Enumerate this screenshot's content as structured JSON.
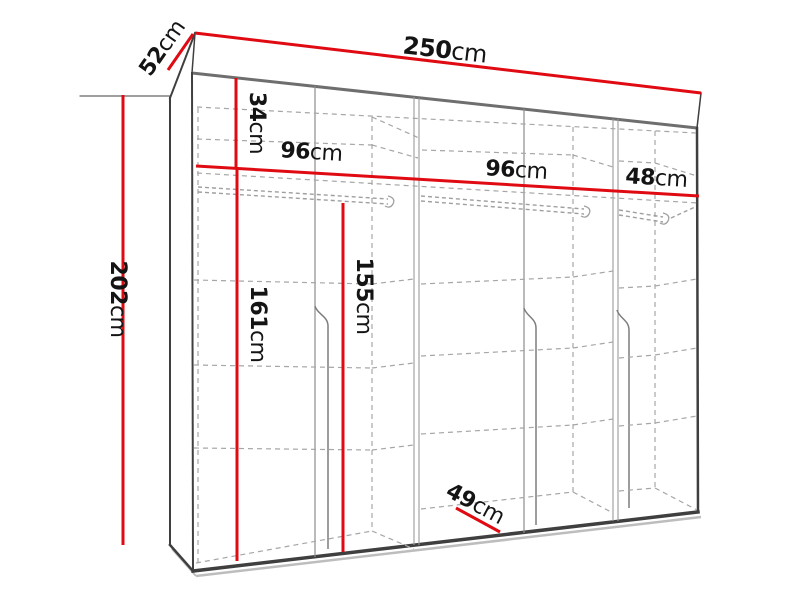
{
  "title": "wardrobe-dimensions-diagram",
  "colors": {
    "accent": "#e00b12",
    "edge-dark": "#3f3f3f",
    "edge-gray": "#6e6e6e",
    "line-gray": "#8c8c8c",
    "dash-gray": "#a6a6a6",
    "text": "#141414",
    "shadow": "#bdbdbd",
    "bg": "#ffffff"
  },
  "dimensions": {
    "width": {
      "value": "250",
      "unit": "cm"
    },
    "depth": {
      "value": "52",
      "unit": "cm"
    },
    "height": {
      "value": "202",
      "unit": "cm"
    },
    "top_shelf": {
      "value": "34",
      "unit": "cm"
    },
    "section_left": {
      "value": "96",
      "unit": "cm"
    },
    "section_middle": {
      "value": "96",
      "unit": "cm"
    },
    "section_right": {
      "value": "48",
      "unit": "cm"
    },
    "hanging_left": {
      "value": "161",
      "unit": "cm"
    },
    "hanging_middle": {
      "value": "155",
      "unit": "cm"
    },
    "interior_depth": {
      "value": "49",
      "unit": "cm"
    }
  }
}
